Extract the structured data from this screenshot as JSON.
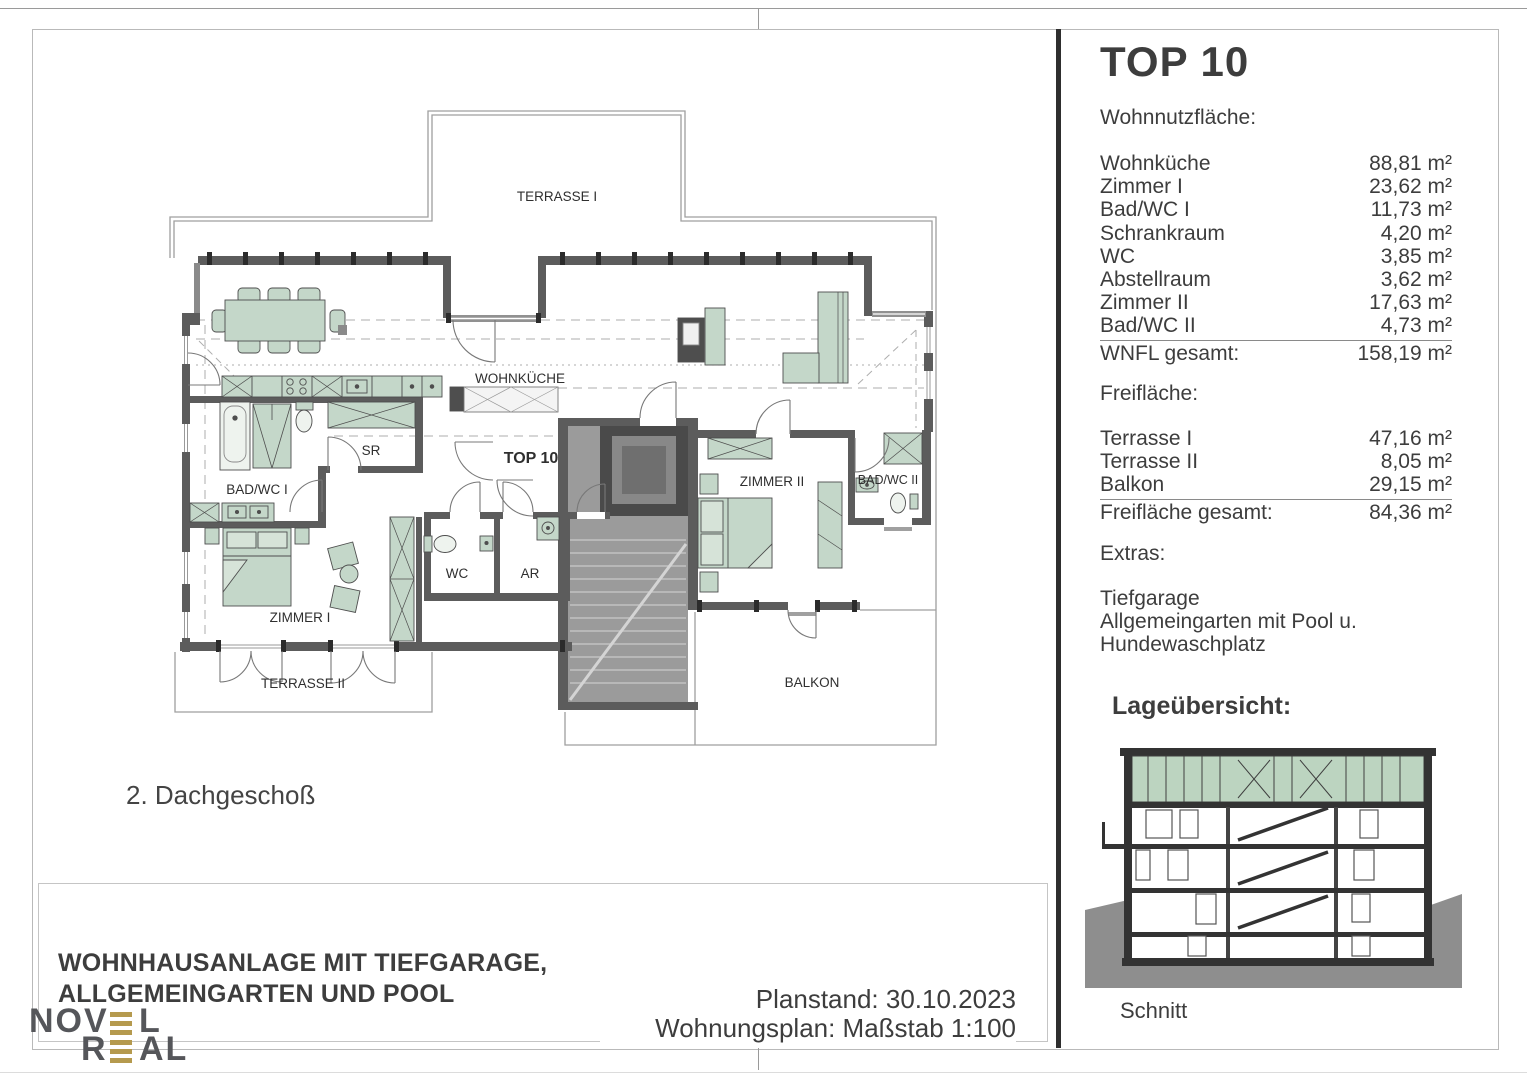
{
  "page": {
    "floor_label": "2. Dachgeschoß"
  },
  "plan": {
    "labels": {
      "terrasse1": "TERRASSE I",
      "wohnkueche": "WOHNKÜCHE",
      "top10": "TOP 10",
      "badwc1": "BAD/WC I",
      "sr": "SR",
      "wc": "WC",
      "ar": "AR",
      "zimmer1": "ZIMMER I",
      "zimmer2": "ZIMMER II",
      "badwc2": "BAD/WC II",
      "terrasse2": "TERRASSE II",
      "balkon": "BALKON"
    }
  },
  "panel": {
    "title": "TOP 10",
    "wnfl_header": "Wohnnutzfläche:",
    "rooms": [
      {
        "label": "Wohnküche",
        "value": "88,81 m²"
      },
      {
        "label": "Zimmer I",
        "value": "23,62 m²"
      },
      {
        "label": "Bad/WC I",
        "value": "11,73 m²"
      },
      {
        "label": "Schrankraum",
        "value": "4,20 m²"
      },
      {
        "label": "WC",
        "value": "3,85 m²"
      },
      {
        "label": "Abstellraum",
        "value": "3,62 m²"
      },
      {
        "label": "Zimmer II",
        "value": "17,63 m²"
      },
      {
        "label": "Bad/WC II",
        "value": "4,73 m²"
      }
    ],
    "wnfl_total": {
      "label": "WNFL gesamt:",
      "value": "158,19 m²"
    },
    "frei_header": "Freifläche:",
    "frei": [
      {
        "label": "Terrasse I",
        "value": "47,16 m²"
      },
      {
        "label": "Terrasse II",
        "value": "8,05 m²"
      },
      {
        "label": "Balkon",
        "value": "29,15 m²"
      }
    ],
    "frei_total": {
      "label": "Freifläche gesamt:",
      "value": "84,36 m²"
    },
    "extras_header": "Extras:",
    "extras": [
      "Tiefgarage",
      "Allgemeingarten mit Pool u.",
      "Hundewaschplatz"
    ],
    "lage_header": "Lageübersicht:",
    "schnitt_label": "Schnitt"
  },
  "titleblock": {
    "line1": "WOHNHAUSANLAGE MIT TIEFGARAGE,",
    "line2": "ALLGEMEINGARTEN UND POOL",
    "planstand": "Planstand: 30.10.2023",
    "massstab": "Wohnungsplan: Maßstab 1:100"
  },
  "logo": {
    "l1a": "NOV",
    "l1b": "L",
    "l2a": "R",
    "l2b": "AL"
  },
  "colors": {
    "furniture_green": "#c4d7c9",
    "glazing_green": "#bcd4c0",
    "wall_gray": "#5c5c5c",
    "core_gray": "#9b9b9b",
    "gold": "#b59a4e",
    "text": "#3d3d3d"
  }
}
